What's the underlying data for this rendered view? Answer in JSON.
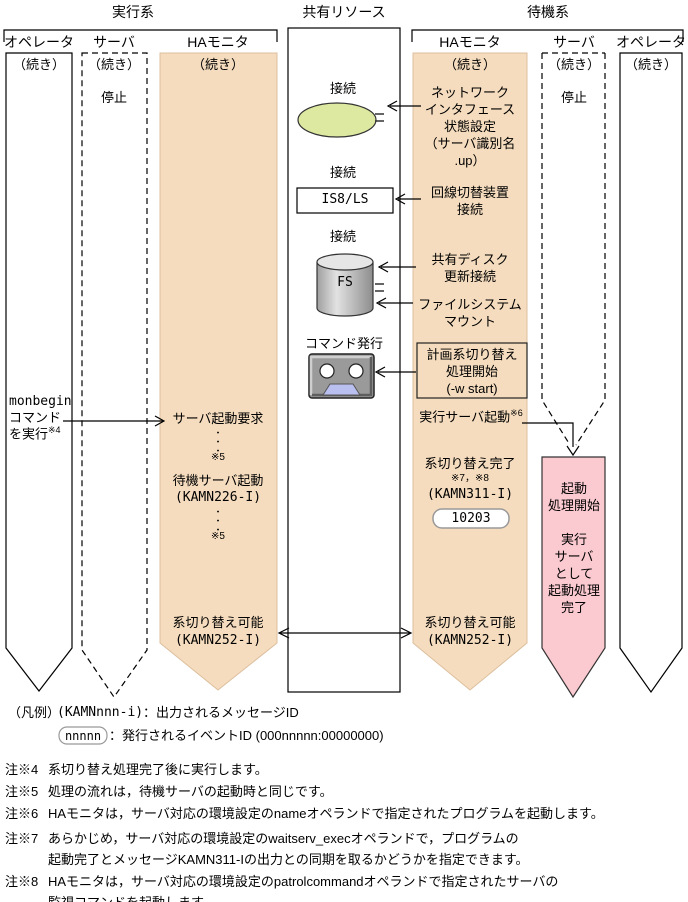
{
  "headers": {
    "exec": "実行系",
    "shared": "共有リソース",
    "standby": "待機系"
  },
  "lanes": {
    "exec_operator": {
      "label": "オペレータ",
      "cont": "（続き）"
    },
    "exec_server": {
      "label": "サーバ",
      "cont": "（続き）",
      "status": "停止"
    },
    "exec_ha": {
      "label": "HAモニタ",
      "cont": "（続き）"
    },
    "standby_ha": {
      "label": "HAモニタ",
      "cont": "（続き）"
    },
    "standby_server": {
      "label": "サーバ",
      "cont": "（続き）",
      "status": "停止"
    },
    "standby_operator": {
      "label": "オペレータ",
      "cont": "（続き）"
    }
  },
  "shared": {
    "connect_top": "接続",
    "connect_mid": "接続",
    "connect_disk": "接続",
    "line_device": "IS8/LS",
    "disk": "FS",
    "command_issue": "コマンド発行"
  },
  "standby_flow": {
    "network_setting": "ネットワーク\nインタフェース\n状態設定\n（サーバ識別名\n.up）",
    "line_switch": "回線切替装置\n接続",
    "disk_update": "共有ディスク\n更新接続",
    "fs_mount": "ファイルシステム\nマウント",
    "planned_switch": "計画系切り替え\n処理開始\n(-w start)",
    "exec_server_start": "実行サーバ起動",
    "exec_server_start_note": "※6",
    "switch_complete": "系切り替え完了",
    "switch_complete_notes": "※7，※8",
    "switch_complete_msg": "(KAMN311-I)",
    "event_id": "10203",
    "switchable": "系切り替え可能",
    "switchable_msg": "(KAMN252-I)"
  },
  "exec_flow": {
    "server_start_request": "サーバ起動要求",
    "dots1": "・\n・\n・",
    "note5a": "※5",
    "standby_server_start": "待機サーバ起動",
    "standby_server_start_msg": "(KAMN226-I)",
    "dots2": "・\n・\n・",
    "note5b": "※5",
    "switchable": "系切り替え可能",
    "switchable_msg": "(KAMN252-I)"
  },
  "operator_action": {
    "line1": "monbegin",
    "line2": "コマンド",
    "line3": "を実行",
    "note": "※4"
  },
  "server_startup": {
    "text": "起動\n処理開始\n\n実行\nサーバ\nとして\n起動処理\n完了"
  },
  "legend": {
    "label": "（凡例）",
    "msg_key": "(KAMNnnn-i)",
    "msg_desc": "：出力されるメッセージID",
    "event_key": "nnnnn",
    "event_desc": "：発行されるイベントID (000nnnnn:00000000)"
  },
  "notes": [
    {
      "ref": "注※4",
      "text": "系切り替え処理完了後に実行します。"
    },
    {
      "ref": "注※5",
      "text": "処理の流れは，待機サーバの起動時と同じです。"
    },
    {
      "ref": "注※6",
      "text": "HAモニタは，サーバ対応の環境設定のnameオペランドで指定されたプログラムを起動します。"
    },
    {
      "ref": "注※7",
      "text": "あらかじめ，サーバ対応の環境設定のwaitserv_execオペランドで，プログラムの\n起動完了とメッセージKAMN311-Iの出力との同期を取るかどうかを指定できます。"
    },
    {
      "ref": "注※8",
      "text": "HAモニタは，サーバ対応の環境設定のpatrolcommandオペランドで指定されたサーバの\n監視コマンドを起動します。"
    }
  ],
  "colors": {
    "ha_lane_fill": "#f5dcbe",
    "server_startup_fill": "#fbcad0",
    "network_ellipse_fill": "#dde8a0",
    "device_trapezoid_fill": "#b9bfef"
  }
}
